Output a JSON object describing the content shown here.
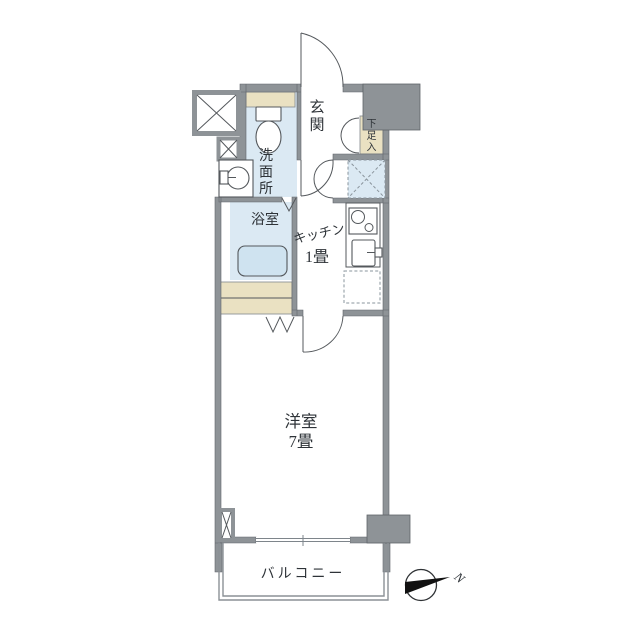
{
  "floor_plan": {
    "colors": {
      "wall": "#8e9397",
      "wet-floor": "#dbe9f3",
      "beige": "#eae1c2",
      "tub": "#cfe3f0",
      "line": "#54585c",
      "needle": "#111111"
    },
    "rooms": {
      "genkan": {
        "label": "玄関"
      },
      "washroom": {
        "label": "洗面所"
      },
      "bathroom": {
        "label": "浴室"
      },
      "kitchen": {
        "label": "キッチン",
        "size": "1畳"
      },
      "western_room": {
        "label": "洋室",
        "size": "7畳"
      },
      "balcony": {
        "label": "バルコニー"
      },
      "shoe_cabinet": {
        "label": "下足入"
      }
    },
    "compass": {
      "north_label": "N"
    }
  }
}
